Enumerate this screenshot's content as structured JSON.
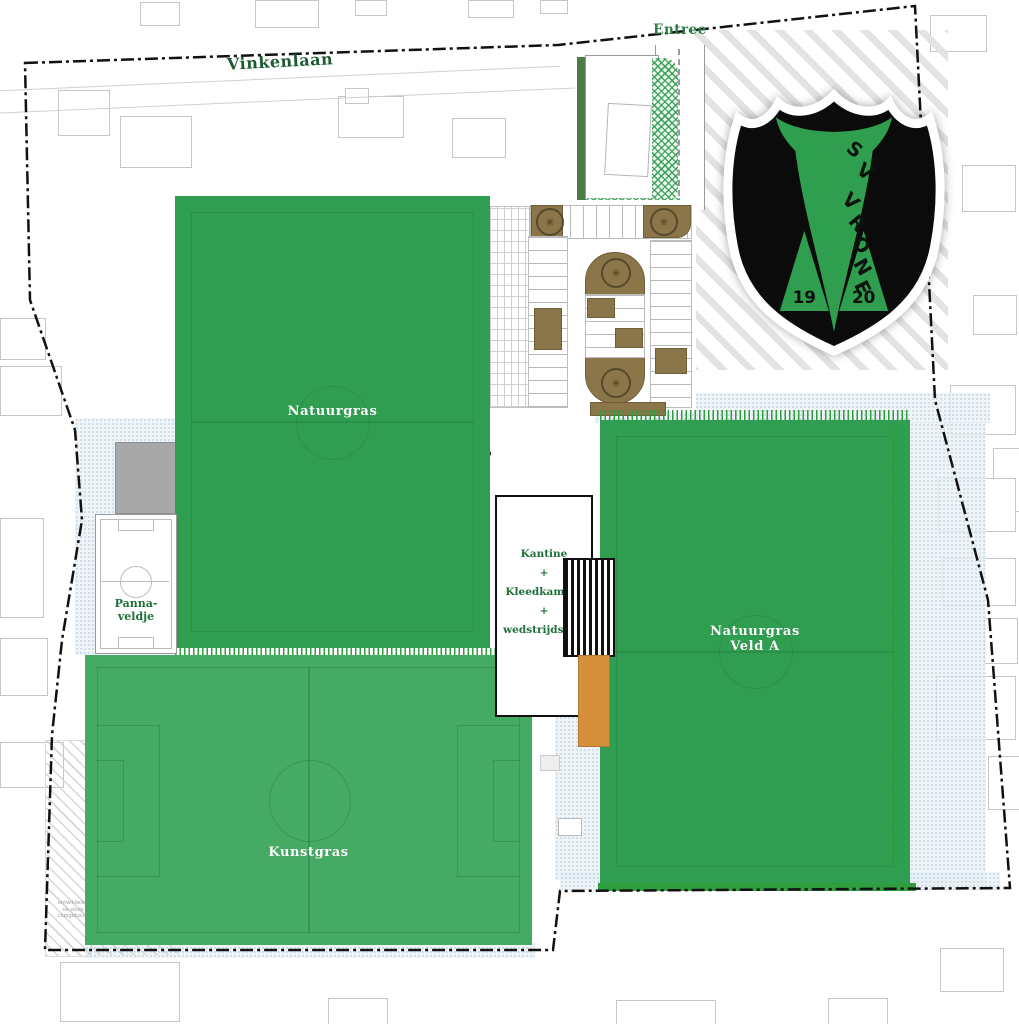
{
  "streets": {
    "vinkenlaan": "Vinkenlaan",
    "entree": "Entree"
  },
  "fields": {
    "natuurgras_main": "Natuurgras",
    "kunstgras": "Kunstgras",
    "veld_a_line1": "Natuurgras",
    "veld_a_line2": "Veld A",
    "panna_line1": "Panna-",
    "panna_line2": "veldje"
  },
  "building": {
    "line1": "Kantine",
    "plus1": "+",
    "line2": "Kleedkamers",
    "plus2": "+",
    "line3": "wedstrijdsecr."
  },
  "logo": {
    "s": "S",
    "v": "V",
    "letters": [
      "V",
      "R",
      "O",
      "N",
      "E"
    ],
    "year_left": "19",
    "year_right": "20"
  },
  "note": {
    "line1": "ontwikkelen",
    "line2": "na sloop",
    "line3": "clubgebouw"
  },
  "icons": {
    "tree": "✳"
  },
  "colors": {
    "natuurgras_green": "#2f9e51",
    "kunstgras_green": "#45aa64",
    "hedge_green": "#2f9e3f",
    "logo_green": "#2f9e4e",
    "street_text_green": "#1d5c33",
    "label_text_green": "#1e6f39",
    "island_brown": "#8a7648",
    "terrace_orange": "#d68f3c",
    "water_dot_blue": "#b9cfdd",
    "boundary_black": "#111111",
    "outline_gray": "#c6c6c6"
  }
}
